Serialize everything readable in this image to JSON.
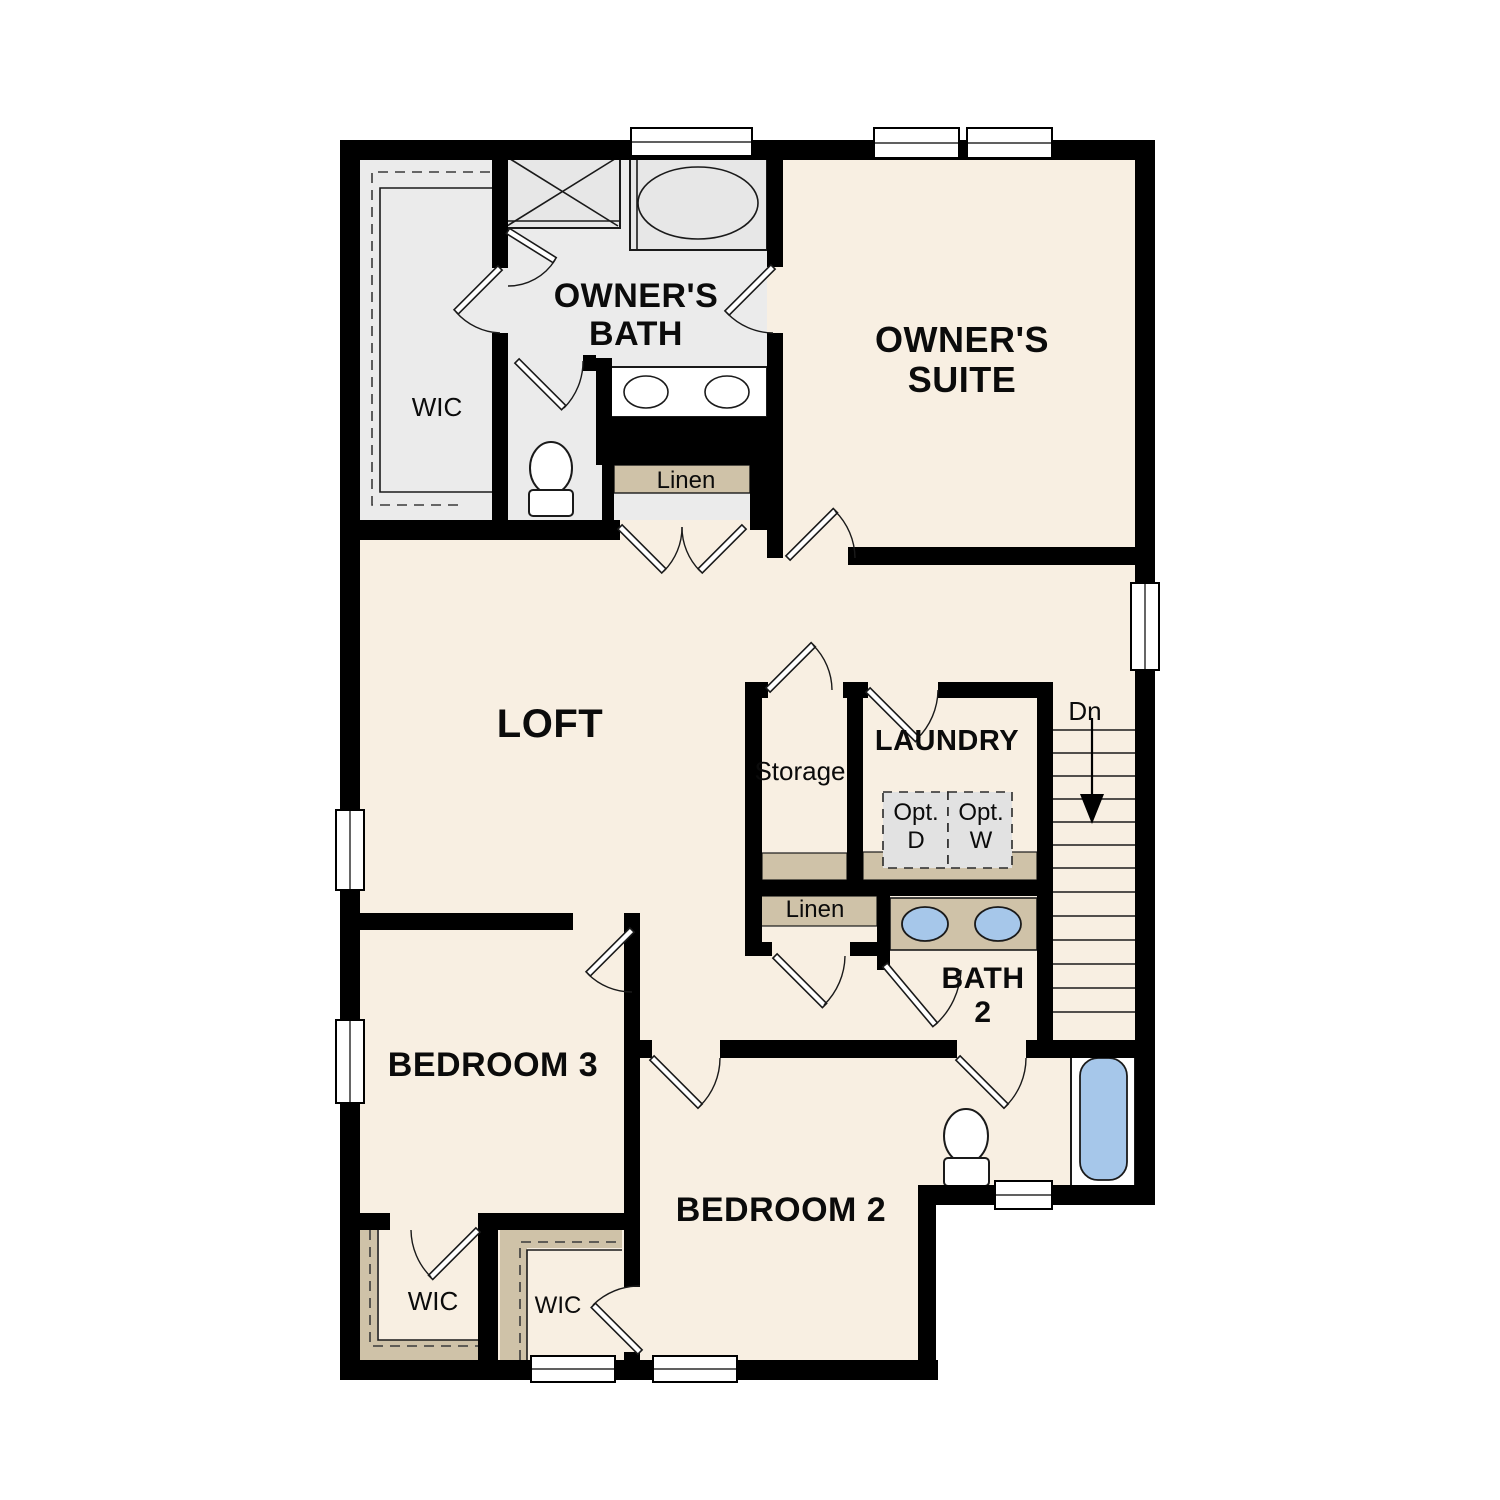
{
  "plan": {
    "floor_name": "Second Floor Plan",
    "colors": {
      "floor": "#f8efe2",
      "bath_floor": "#ebebeb",
      "wall": "#000000",
      "millwork": "#cfc2a8",
      "fixture_blue": "#a6c7ea",
      "optional_box": "#e2e2e2"
    },
    "rooms": {
      "owners_bath": {
        "line1": "OWNER'S",
        "line2": "BATH"
      },
      "owners_suite": {
        "line1": "OWNER'S",
        "line2": "SUITE"
      },
      "loft": {
        "label": "LOFT"
      },
      "storage": {
        "label": "Storage"
      },
      "laundry": {
        "label": "LAUNDRY"
      },
      "bath2": {
        "line1": "BATH",
        "line2": "2"
      },
      "bedroom3": {
        "label": "BEDROOM 3"
      },
      "bedroom2": {
        "label": "BEDROOM 2"
      },
      "wic_owner": {
        "label": "WIC"
      },
      "wic_bedroom3": {
        "label": "WIC"
      },
      "wic_bedroom2": {
        "label": "WIC"
      },
      "linen_upper": {
        "label": "Linen"
      },
      "linen_lower": {
        "label": "Linen"
      },
      "stairs": {
        "down_label": "Dn"
      },
      "optional_dryer": {
        "line1": "Opt.",
        "line2": "D"
      },
      "optional_washer": {
        "line1": "Opt.",
        "line2": "W"
      }
    }
  }
}
